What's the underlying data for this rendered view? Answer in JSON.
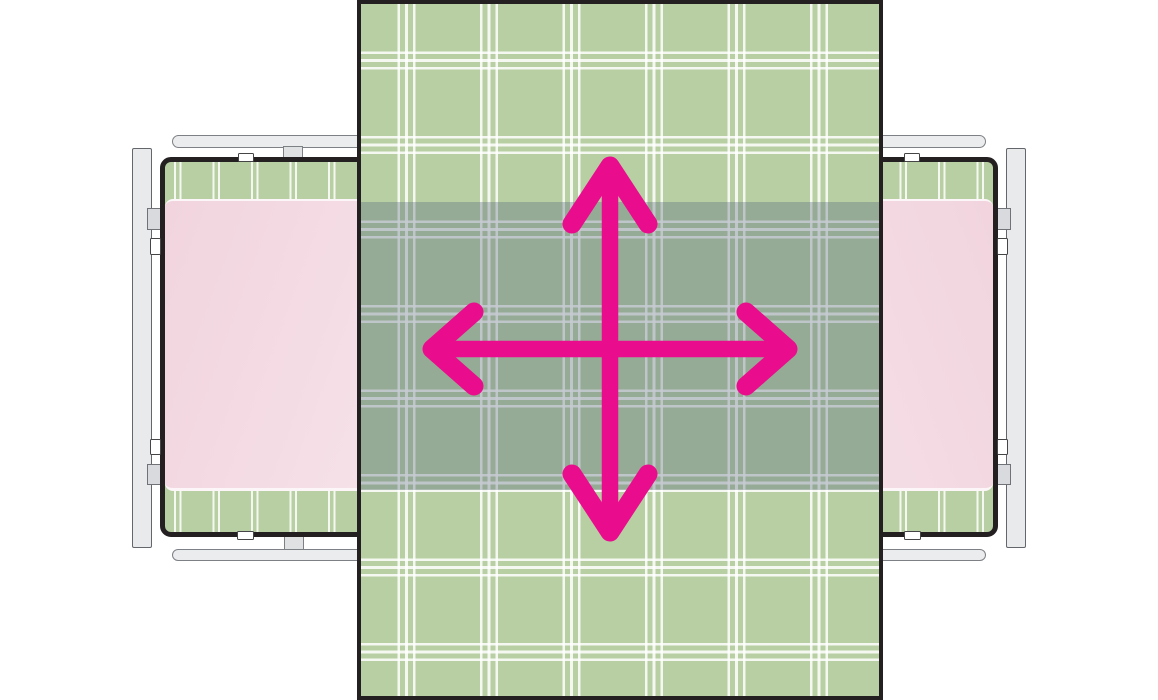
{
  "title": "",
  "visible_text": [],
  "colors": {
    "background": "#ffffff",
    "outline_black": "#242021",
    "cloth_green": "#b7cfa3",
    "plaid_line": "rgba(255,255,255,0.85)",
    "band_overlay": "rgba(88,104,124,0.34)",
    "pad_pink_dark": "#f1d4de",
    "pad_pink_light": "#f9ebf0",
    "metal_fill": "#e8eaec",
    "metal_border": "#7d8084",
    "clip_fill": "#d8dadd",
    "notch_fill": "#ffffff",
    "arrow_magenta": "#e90d8d"
  },
  "arrow": {
    "icon": "move-four-directions-arrow",
    "shafts_d": "M610 172 L610 526 M434 349 L786 349",
    "heads_d": "M572 224 L610 166 L648 224 M572 474 L610 532 L648 474 M474 312 L432 349 L474 386 M746 312 L788 349 L746 386",
    "shaft_width": 16.5,
    "head_width": 19
  },
  "plaid": {
    "cloth_cluster_lines": 3,
    "cloth_period_px": 82.5,
    "table_cluster_lines": 2,
    "table_period_px": 38.5
  },
  "parts": {
    "center_cloth": "large green plaid cloth spanning full height",
    "shaded_band": "semi-transparent gray band where cloth overlaps the two frames",
    "left_frame": "gray-railed frame with plaid top and pink pad",
    "right_frame": "mirrored gray-railed frame with plaid top and pink pad",
    "arrow": "magenta four-direction move arrow centered on cloth"
  }
}
